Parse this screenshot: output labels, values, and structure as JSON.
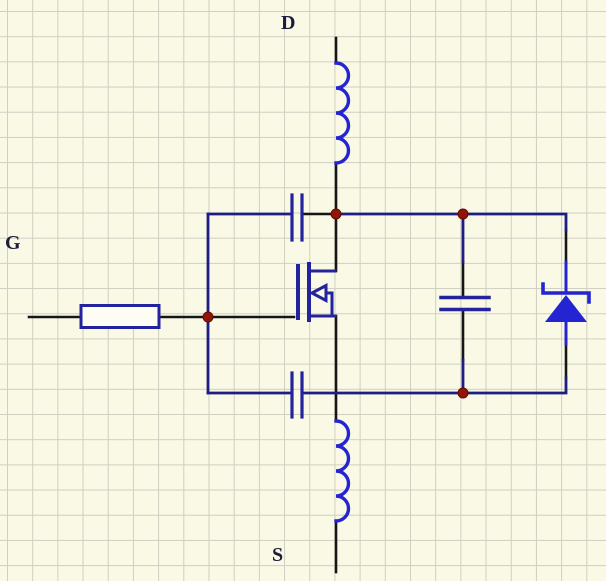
{
  "sheet": {
    "type": "circuit-schematic",
    "background_color": "#f9f9e6",
    "grid_color": "#cfcfc2",
    "grid_spacing_px": 25
  },
  "labels": {
    "drain_port": "D",
    "gate_port": "G",
    "source_port": "S"
  },
  "colors": {
    "sheet_bg": "#f9f9e6",
    "grid_line": "#cfcfc2",
    "wire_black": "#161616",
    "wire_navy": "#1d1d84",
    "comp_navy": "#23239e",
    "comp_blue": "#2424d2",
    "junction_red": "#941508",
    "label_text": "#1c1c3c",
    "resistor_fill": "#fdfdf3"
  },
  "components": [
    {
      "name": "drain-inductor",
      "type": "inductor"
    },
    {
      "name": "gate-resistor",
      "type": "resistor"
    },
    {
      "name": "gate-drain-capacitor",
      "type": "capacitor"
    },
    {
      "name": "gate-source-capacitor",
      "type": "capacitor"
    },
    {
      "name": "power-mosfet",
      "type": "n-channel-mosfet"
    },
    {
      "name": "drain-source-capacitor",
      "type": "capacitor"
    },
    {
      "name": "protection-zener-diode",
      "type": "zener-diode"
    },
    {
      "name": "source-inductor",
      "type": "inductor"
    }
  ],
  "junction_count": 4
}
